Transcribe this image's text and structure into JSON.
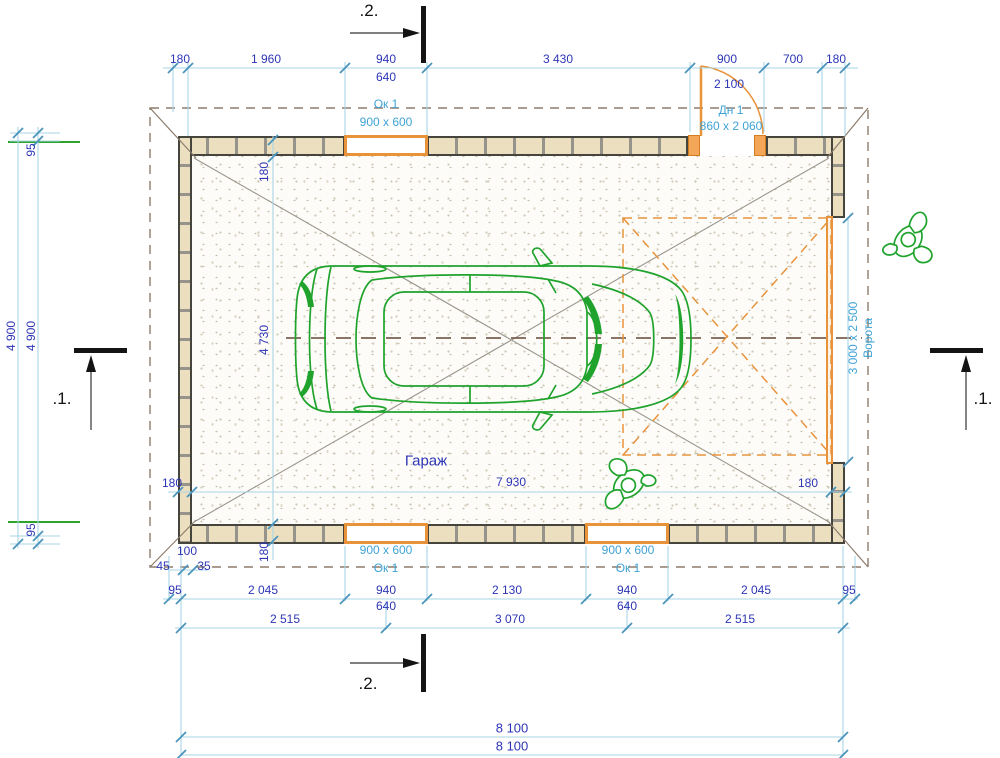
{
  "drawing_type": "garage floor plan",
  "sections": {
    "s1": ".1.",
    "s2": ".2."
  },
  "room_label": "Гараж",
  "openings": {
    "window_tag": "Ок 1",
    "window_size": "900 x 600",
    "door_tag": "Дн 1",
    "door_size": "860 x 2 060",
    "door_height": "2 100",
    "gate_label": "Ворота",
    "gate_size": "3 000 x 2 500"
  },
  "dims": {
    "top": [
      "180",
      "1 960",
      "940",
      "3 430",
      "900",
      "700",
      "180"
    ],
    "window_640": "640",
    "left": {
      "outer": "4 900",
      "inner": "4 900",
      "edge_top": "95",
      "edge_bottom": "95"
    },
    "interior": {
      "width": "7 930",
      "height": "4 730",
      "wall": "180"
    },
    "bottom": {
      "micro": {
        "a": "45",
        "b": "100",
        "c": "35"
      },
      "row1": [
        "95",
        "2 045",
        "940",
        "2 130",
        "940",
        "2 045",
        "95"
      ],
      "row2": [
        "2 515",
        "3 070",
        "2 515"
      ],
      "overall1": "8 100",
      "overall2": "8 100"
    }
  },
  "colors": {
    "dim_text_blue": "#2d35b5",
    "label_light_blue": "#3fa3d6",
    "dim_line_blue": "#a9d4e5",
    "tick_blue": "#4a94bc",
    "opening_orange": "#e8923a",
    "entity_green": "#1fa32c",
    "wall_dark": "#45453e",
    "wall_fill": "#ecdfc0",
    "roof_dash": "#8d7c6c",
    "axis_dash": "#7a6050",
    "diagonal_gray": "#9a968c",
    "marker_black": "#141414"
  }
}
